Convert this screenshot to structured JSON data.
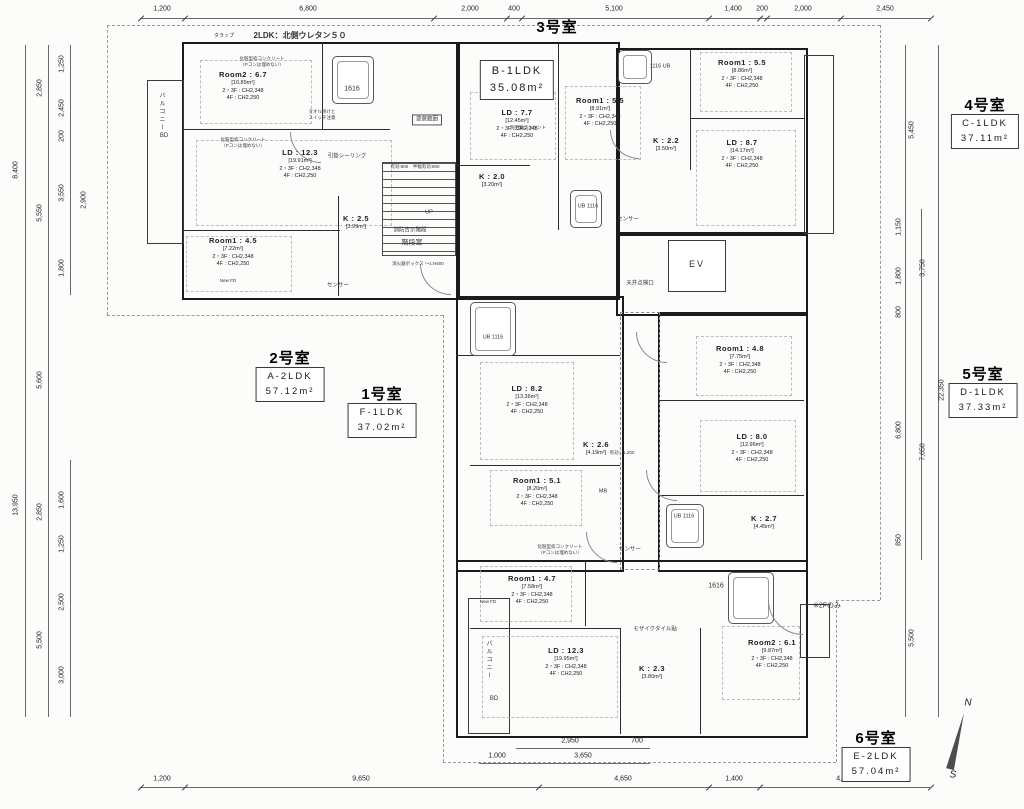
{
  "header": {
    "trap_label": "タラップ",
    "spec_note": "2LDK：北側ウレタン５０",
    "only_2f": "※2Fのみ"
  },
  "units": [
    {
      "no": "1号室",
      "type": "F-1LDK",
      "area": "37.02m²"
    },
    {
      "no": "2号室",
      "type": "A-2LDK",
      "area": "57.12m²"
    },
    {
      "no": "3号室",
      "type": "B-1LDK",
      "area": "35.08m²"
    },
    {
      "no": "4号室",
      "type": "C-1LDK",
      "area": "37.11m²"
    },
    {
      "no": "5号室",
      "type": "D-1LDK",
      "area": "37.33m²"
    },
    {
      "no": "6号室",
      "type": "E-2LDK",
      "area": "57.04m²"
    }
  ],
  "rooms": [
    {
      "name": "Room2 : 6.7",
      "area": "[10.89m²]",
      "ch1": "2・3F : CH2,348",
      "ch2": "4F : CH2,250"
    },
    {
      "name": "LD : 12.3",
      "area": "[19.91m²]",
      "ch1": "2・3F : CH2,348",
      "ch2": "4F : CH2,250"
    },
    {
      "name": "Room1 : 4.5",
      "area": "[7.22m²]",
      "ch1": "2・3F : CH2,348",
      "ch2": "4F : CH2,250"
    },
    {
      "name": "K : 2.5",
      "area": "[3.99m²]"
    },
    {
      "name": "LD : 7.7",
      "area": "[12.45m²]",
      "ch1": "2・3F : CH2,348",
      "ch2": "4F : CH2,250"
    },
    {
      "name": "Room1 : 5.5",
      "area": "[8.91m²]",
      "ch1": "2・3F : CH2,348",
      "ch2": "4F : CH2,250"
    },
    {
      "name": "K : 2.0",
      "area": "[3.20m²]"
    },
    {
      "name": "Room1 : 5.5",
      "area": "[8.86m²]",
      "ch1": "2・3F : CH2,348",
      "ch2": "4F : CH2,250"
    },
    {
      "name": "LD : 8.7",
      "area": "[14.17m²]",
      "ch1": "2・3F : CH2,348",
      "ch2": "4F : CH2,250"
    },
    {
      "name": "K : 2.2",
      "area": "[3.50m²]"
    },
    {
      "name": "LD : 8.2",
      "area": "[13.36m²]",
      "ch1": "2・3F : CH2,348",
      "ch2": "4F : CH2,250"
    },
    {
      "name": "K : 2.6",
      "area": "[4.19m²]"
    },
    {
      "name": "Room1 : 5.1",
      "area": "[8.20m²]",
      "ch1": "2・3F : CH2,348",
      "ch2": "4F : CH2,250"
    },
    {
      "name": "Room1 : 4.8",
      "area": "[7.75m²]",
      "ch1": "2・3F : CH2,348",
      "ch2": "4F : CH2,250"
    },
    {
      "name": "LD : 8.0",
      "area": "[12.96m²]",
      "ch1": "2・3F : CH2,348",
      "ch2": "4F : CH2,250"
    },
    {
      "name": "K : 2.7",
      "area": "[4.45m²]"
    },
    {
      "name": "Room1 : 4.7",
      "area": "[7.58m²]",
      "ch1": "2・3F : CH2,348",
      "ch2": "4F : CH2,250"
    },
    {
      "name": "LD : 12.3",
      "area": "[19.95m²]",
      "ch1": "2・3F : CH2,348",
      "ch2": "4F : CH2,250"
    },
    {
      "name": "K : 2.3",
      "area": "[3.80m²]"
    },
    {
      "name": "Room2 : 6.1",
      "area": "[9.87m²]",
      "ch1": "2・3F : CH2,348",
      "ch2": "4F : CH2,250"
    }
  ],
  "dims": {
    "top": [
      "1,200",
      "6,800",
      "2,000",
      "400",
      "5,100",
      "1,400",
      "200",
      "2,000",
      "2,450"
    ],
    "bottom": [
      "1,200",
      "9,650",
      "4,650",
      "1,400",
      "4,650"
    ],
    "bottom_sub": [
      "2,950",
      "700",
      "1,000",
      "3,650"
    ],
    "left": [
      "8,400",
      "13,950",
      "2,850",
      "5,550",
      "5,600",
      "2,850",
      "5,500",
      "1,250",
      "2,450",
      "200",
      "3,550",
      "2,900",
      "1,800",
      "1,600",
      "1,250",
      "2,500",
      "3,000"
    ],
    "right": [
      "5,450",
      "1,150",
      "1,800",
      "800",
      "6,800",
      "850",
      "5,500",
      "3,750",
      "7,650",
      "22,350"
    ]
  },
  "annotations": {
    "stair_room": "階段室",
    "fire_stair": "消防告示階段",
    "up": "UP",
    "ev": "EV",
    "sensor": "センサー",
    "ceiling_hatch": "天井点検口",
    "mb": "MB",
    "mosaic_tile": "モザイクタイル貼",
    "effective_1200": "有効：1,200",
    "effective_800": "有効:800　半幅有効:800",
    "paint_range": "塗装範囲",
    "towel_note1": "タオル掛けと",
    "towel_note2": "スイッチ注意",
    "concrete1": "化粧型枠コンクリート",
    "concrete2": "（Pコンは埋めない）",
    "ceiling_light": "引掛シーリング",
    "outlet": "別回路コンセント",
    "ext_box": "消火器ボックス 〜1:H600",
    "balcony": "バルコニー",
    "bd": "BD",
    "new_fd": "New FD"
  },
  "fixtures": {
    "tub_1616": "1616",
    "ub_1116": "UB 1116",
    "ub_1116b": "1116 UB"
  },
  "compass": {
    "n": "N",
    "s": "S"
  }
}
